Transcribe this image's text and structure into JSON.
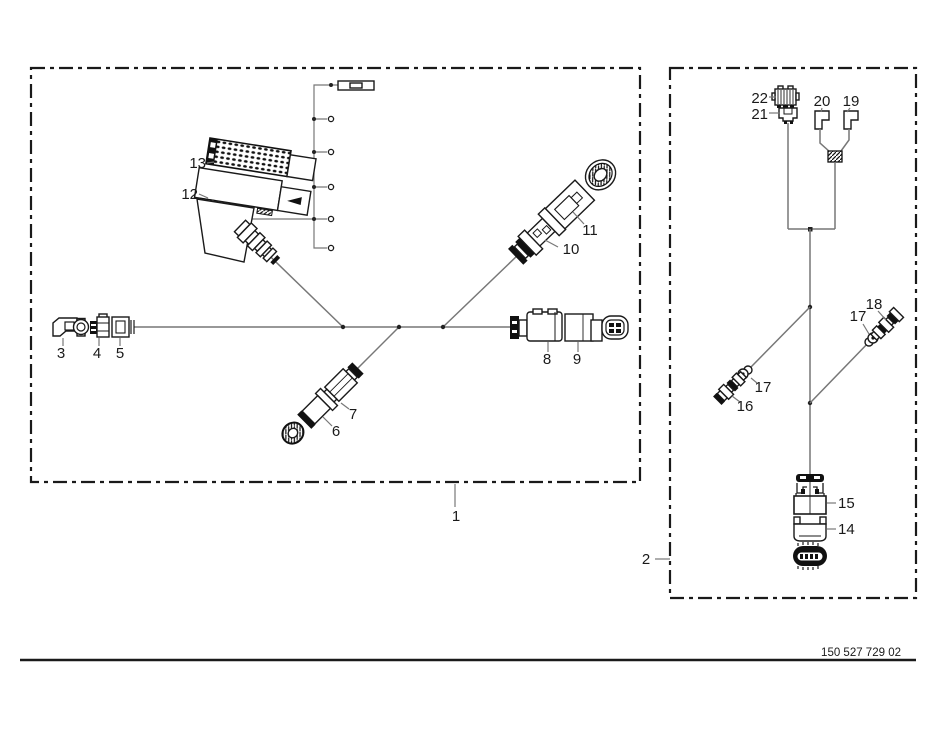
{
  "document": {
    "part_number": "150 527 729 02"
  },
  "callouts": {
    "n1": "1",
    "n2": "2",
    "n3": "3",
    "n4": "4",
    "n5": "5",
    "n6": "6",
    "n7": "7",
    "n8": "8",
    "n9": "9",
    "n10": "10",
    "n11": "11",
    "n12": "12",
    "n13": "13",
    "n14": "14",
    "n15": "15",
    "n16": "16",
    "n17": "17",
    "n18": "18",
    "n19": "19",
    "n20": "20",
    "n21": "21",
    "n22": "22"
  },
  "colors": {
    "ink": "#1a1a1a",
    "wire": "#777777",
    "background": "#ffffff"
  }
}
